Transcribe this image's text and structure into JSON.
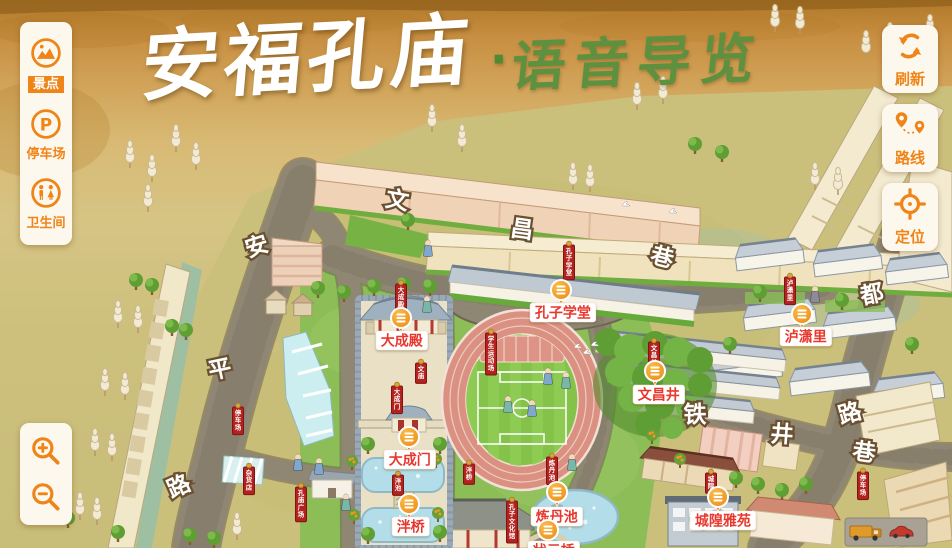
{
  "title": {
    "main": "安福孔庙",
    "separator": "·",
    "sub": "语音导览"
  },
  "sidebar": {
    "items": [
      {
        "id": "scenic",
        "label": "景点",
        "icon": "scenic-spot-icon",
        "active": true
      },
      {
        "id": "parking",
        "label": "停车场",
        "icon": "parking-icon",
        "active": false
      },
      {
        "id": "restroom",
        "label": "卫生间",
        "icon": "restroom-icon",
        "active": false
      }
    ]
  },
  "map_controls": {
    "buttons": [
      {
        "id": "refresh",
        "label": "刷新",
        "icon": "refresh-icon"
      },
      {
        "id": "route",
        "label": "路线",
        "icon": "route-icon"
      },
      {
        "id": "locate",
        "label": "定位",
        "icon": "locate-icon"
      }
    ]
  },
  "zoom_controls": {
    "buttons": [
      {
        "id": "zoom-in",
        "icon": "zoom-in-icon"
      },
      {
        "id": "zoom-out",
        "icon": "zoom-out-icon"
      }
    ]
  },
  "map": {
    "colors": {
      "accent": "#ef8418",
      "label_red": "#e8392e",
      "banner_red": "#b3221e",
      "marker_orange": "#f19a1f",
      "title_green": "#5d9140"
    },
    "pois": [
      {
        "name": "大成殿",
        "marker": [
          401,
          318
        ],
        "label": [
          376,
          331
        ]
      },
      {
        "name": "孔子学堂",
        "marker": [
          561,
          290
        ],
        "label": [
          530,
          303
        ]
      },
      {
        "name": "泸潇里",
        "marker": [
          802,
          314
        ],
        "label": [
          780,
          327
        ]
      },
      {
        "name": "文昌井",
        "marker": [
          655,
          371
        ],
        "label": [
          633,
          385
        ]
      },
      {
        "name": "大成门",
        "marker": [
          409,
          437
        ],
        "label": [
          384,
          450
        ]
      },
      {
        "name": "泮桥",
        "marker": [
          409,
          504
        ],
        "label": [
          392,
          517
        ]
      },
      {
        "name": "炼丹池",
        "marker": [
          557,
          492
        ],
        "label": [
          531,
          507
        ]
      },
      {
        "name": "城隍雅苑",
        "marker": [
          718,
          497
        ],
        "label": [
          690,
          511
        ]
      },
      {
        "name": "状元桥",
        "marker": [
          548,
          530
        ],
        "label": [
          528,
          541
        ]
      }
    ],
    "street_chars": [
      {
        "ch": "安",
        "x": 257,
        "y": 247,
        "rot": -18
      },
      {
        "ch": "平",
        "x": 220,
        "y": 370,
        "rot": -12
      },
      {
        "ch": "路",
        "x": 179,
        "y": 487,
        "rot": -24
      },
      {
        "ch": "文",
        "x": 397,
        "y": 201,
        "rot": 10
      },
      {
        "ch": "昌",
        "x": 522,
        "y": 230,
        "rot": 8
      },
      {
        "ch": "巷",
        "x": 662,
        "y": 258,
        "rot": 14
      },
      {
        "ch": "都",
        "x": 872,
        "y": 295,
        "rot": -12
      },
      {
        "ch": "路",
        "x": 850,
        "y": 414,
        "rot": -16
      },
      {
        "ch": "铁",
        "x": 695,
        "y": 415,
        "rot": 0
      },
      {
        "ch": "井",
        "x": 782,
        "y": 435,
        "rot": 4
      },
      {
        "ch": "巷",
        "x": 864,
        "y": 453,
        "rot": 8
      }
    ],
    "banners": [
      {
        "text": "大成殿",
        "x": 401,
        "y": 284
      },
      {
        "text": "文庙",
        "x": 421,
        "y": 363
      },
      {
        "text": "大成门",
        "x": 397,
        "y": 386
      },
      {
        "text": "学生运动场",
        "x": 491,
        "y": 333
      },
      {
        "text": "孔子学堂",
        "x": 569,
        "y": 245
      },
      {
        "text": "文昌井",
        "x": 654,
        "y": 342
      },
      {
        "text": "泸潇里",
        "x": 790,
        "y": 277
      },
      {
        "text": "泮桥",
        "x": 469,
        "y": 464
      },
      {
        "text": "泮池",
        "x": 398,
        "y": 475
      },
      {
        "text": "孔子文化馆",
        "x": 512,
        "y": 501
      },
      {
        "text": "炼丹池",
        "x": 552,
        "y": 457
      },
      {
        "text": "城隍",
        "x": 711,
        "y": 473
      },
      {
        "text": "停车场",
        "x": 863,
        "y": 472
      },
      {
        "text": "停车场",
        "x": 238,
        "y": 407
      },
      {
        "text": "杂货店",
        "x": 249,
        "y": 467
      },
      {
        "text": "孔庙广场",
        "x": 301,
        "y": 487
      }
    ]
  }
}
